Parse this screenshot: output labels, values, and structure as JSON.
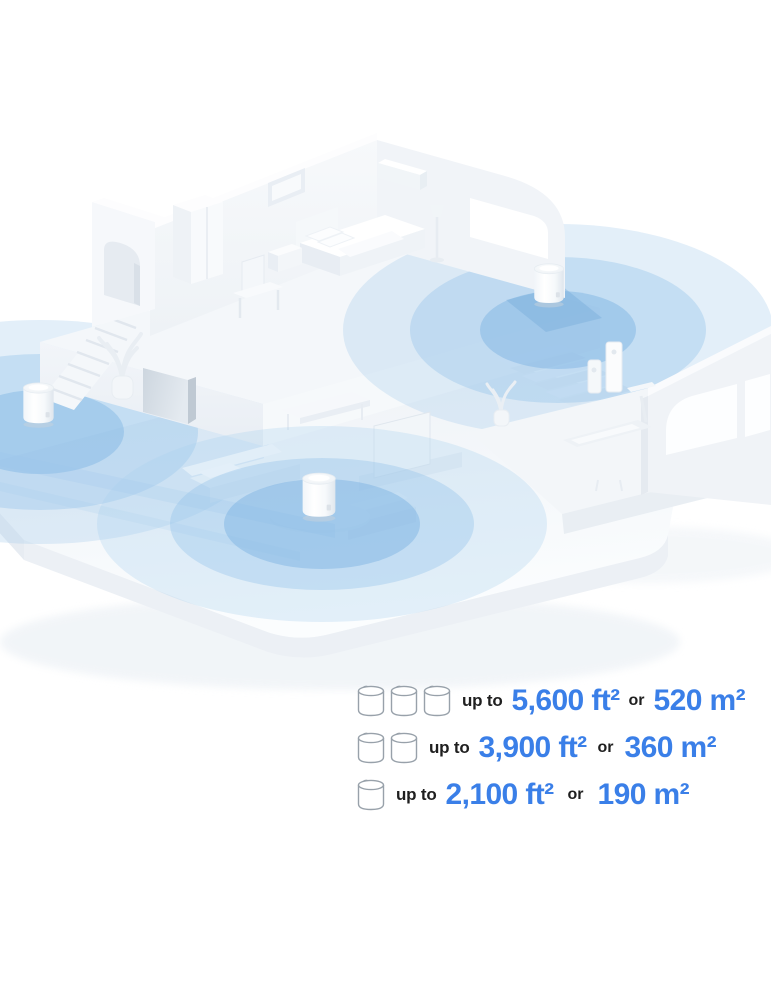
{
  "coverage_legend": {
    "accent_color": "#3A7FE8",
    "text_color": "#1F1F1F",
    "rows": [
      {
        "units": 3,
        "prefix": "up to",
        "imperial": "5,600 ft²",
        "conjunction": "or",
        "metric": "520 m²"
      },
      {
        "units": 2,
        "prefix": "up to",
        "imperial": "3,900 ft²",
        "conjunction": "or",
        "metric": "360 m²"
      },
      {
        "units": 1,
        "prefix": "up to",
        "imperial": "2,100 ft²",
        "conjunction": "or",
        "metric": "190 m²"
      }
    ]
  },
  "illustration": {
    "deco_unit_locations": [
      "upper-floor",
      "ground-floor-left",
      "living-room-coffee-table"
    ],
    "coverage_color_inner": "#7AB2E2",
    "coverage_color_outer": "#AACFEE"
  }
}
